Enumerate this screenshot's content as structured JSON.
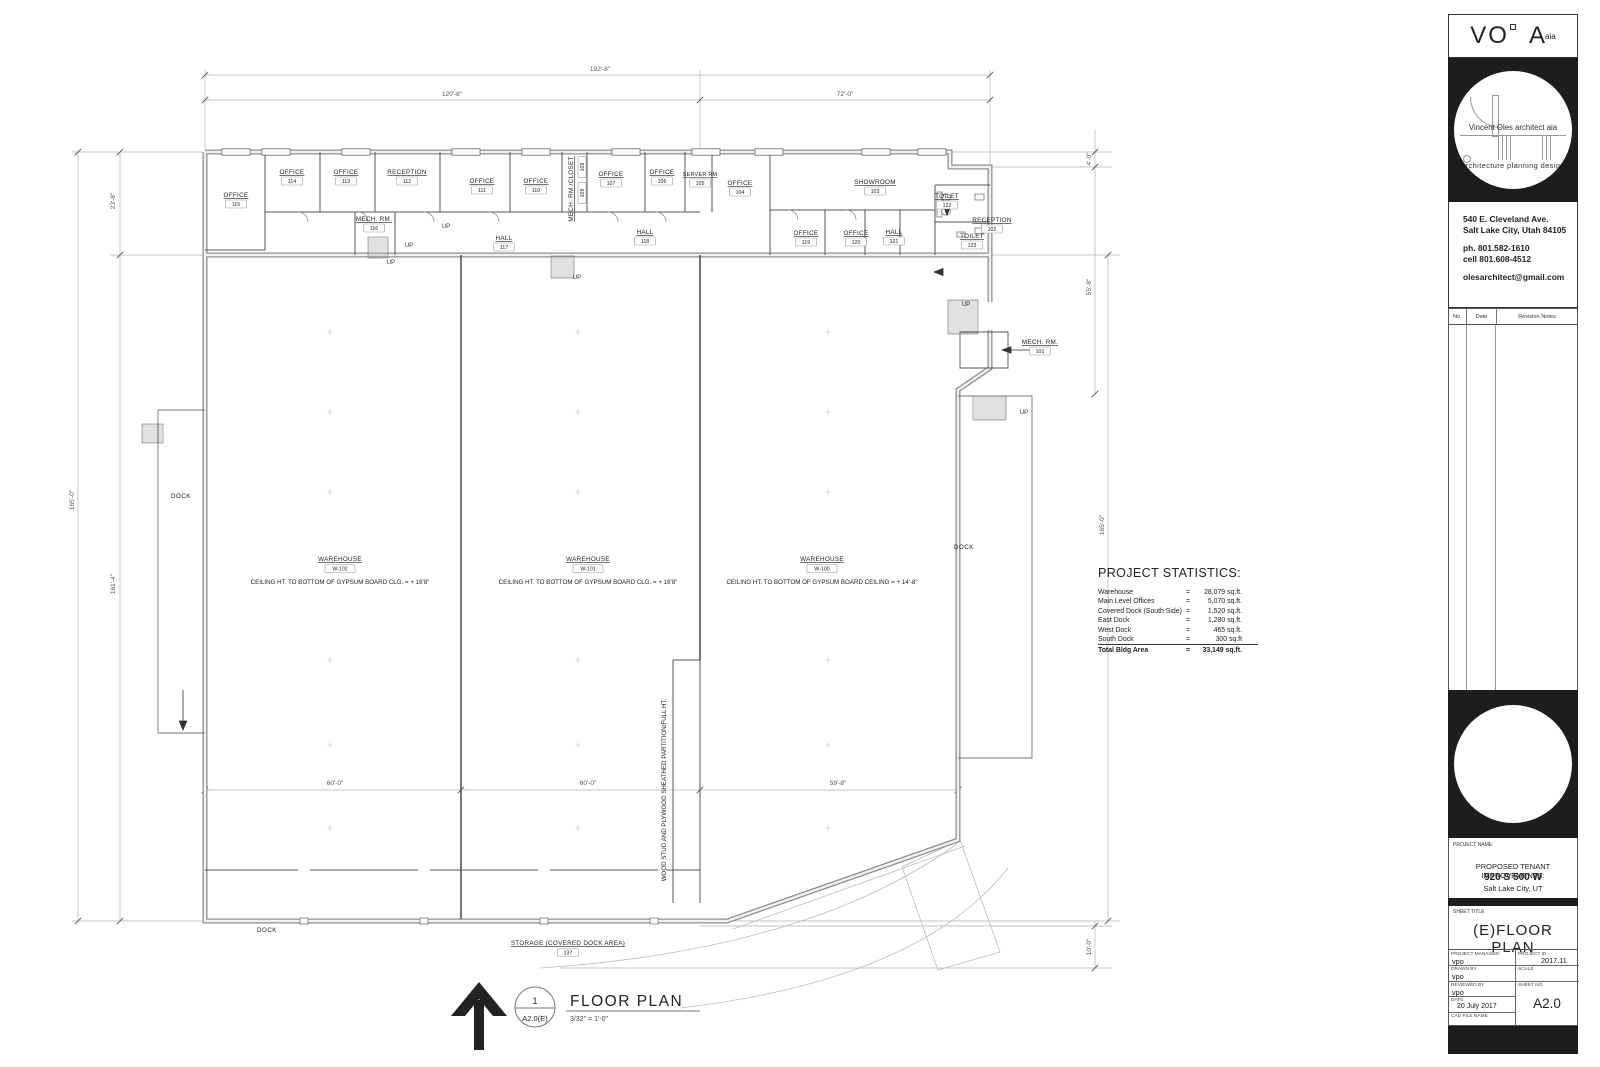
{
  "title_block": {
    "logo": {
      "vo": "VO",
      "a": "A",
      "aia": "aia"
    },
    "circle_text1": "Vincent Oles architect aia",
    "circle_text2": "architecture  planning  design",
    "address1": "540 E. Cleveland Ave.",
    "address2": "Salt Lake City, Utah 84105",
    "phone": "ph. 801.582-1610",
    "cell": "cell 801.608-4512",
    "email": "olesarchitect@gmail.com",
    "rev_headers": {
      "no": "No.",
      "date": "Date",
      "notes": "Revision Notes"
    },
    "project_name_label": "PROJECT NAME:",
    "project_line1": "PROPOSED TENANT IMPROVEMENTS:",
    "project_line2": "920 S 500 W",
    "project_line3": "Salt Lake City, UT",
    "sheet_title_label": "SHEET TITLE",
    "sheet_title": "(E)FLOOR  PLAN",
    "pm_label": "PROJECT MANAGER:",
    "pm": "vpo",
    "pid_label": "PROJECT ID",
    "pid": "2017.11",
    "drawn_label": "DRAWN BY",
    "drawn": "vpo",
    "scale_label": "SCALE",
    "reviewed_label": "REVIEWED BY",
    "reviewed": "vpo",
    "sheetno_label": "SHEET NO.",
    "sheetno": "A2.0",
    "date_label": "DATE",
    "date": "20 July 2017",
    "cad_label": "CAD FILE NAME"
  },
  "plan": {
    "title": {
      "num": "1",
      "ref": "A2.0(E)",
      "name": "FLOOR PLAN",
      "scale": "3/32\" = 1'-0\""
    },
    "stats": {
      "title": "PROJECT STATISTICS:",
      "eq": "=",
      "rows": [
        {
          "n": "Warehouse",
          "v": "28,079 sq.ft."
        },
        {
          "n": "Main Level Offices",
          "v": "5,070 sq.ft."
        },
        {
          "n": "Covered Dock (South Side)",
          "v": "1,520 sq.ft."
        },
        {
          "n": "East Dock",
          "v": "1,280 sq.ft."
        },
        {
          "n": "West Dock",
          "v": "465 sq.ft."
        },
        {
          "n": "South Dock",
          "v": "300 sq.ft",
          "underline": true
        }
      ],
      "total": {
        "n": "Total Bldg Area",
        "v": "33,149 sq.ft."
      }
    },
    "rooms": [
      {
        "n": "OFFICE",
        "id": "115",
        "x": 236,
        "y": 197
      },
      {
        "n": "OFFICE",
        "id": "114",
        "x": 292,
        "y": 174
      },
      {
        "n": "OFFICE",
        "id": "113",
        "x": 346,
        "y": 174
      },
      {
        "n": "RECEPTION",
        "id": "112",
        "x": 407,
        "y": 174
      },
      {
        "n": "MECH. RM.",
        "id": "116",
        "x": 374,
        "y": 221
      },
      {
        "n": "OFFICE",
        "id": "111",
        "x": 482,
        "y": 183
      },
      {
        "n": "OFFICE",
        "id": "110",
        "x": 536,
        "y": 183
      },
      {
        "n": "OFFICE",
        "id": "107",
        "x": 611,
        "y": 176
      },
      {
        "n": "OFFICE",
        "id": "106",
        "x": 662,
        "y": 174
      },
      {
        "n": "SERVER RM",
        "id": "105",
        "x": 700,
        "y": 176,
        "fs": 5.4
      },
      {
        "n": "HALL",
        "id": "117",
        "x": 504,
        "y": 240
      },
      {
        "n": "HALL",
        "id": "118",
        "x": 645,
        "y": 234
      },
      {
        "n": "OFFICE",
        "id": "104",
        "x": 740,
        "y": 185
      },
      {
        "n": "SHOWROOM",
        "id": "103",
        "x": 875,
        "y": 184
      },
      {
        "n": "TOILET",
        "id": "122",
        "x": 947,
        "y": 198
      },
      {
        "n": "OFFICE",
        "id": "119",
        "x": 806,
        "y": 235
      },
      {
        "n": "OFFICE",
        "id": "120",
        "x": 856,
        "y": 235
      },
      {
        "n": "HALL",
        "id": "121",
        "x": 894,
        "y": 234
      },
      {
        "n": "TOILET",
        "id": "123",
        "x": 972,
        "y": 238
      },
      {
        "n": "RECEPTION",
        "id": "102",
        "x": 992,
        "y": 222
      },
      {
        "n": "MECH. RM.",
        "id": "101",
        "x": 1040,
        "y": 344
      }
    ],
    "mech_closet": {
      "name": "MECH. RM./CLOSET",
      "num_top": "108",
      "num_bot": "109"
    },
    "warehouses": [
      {
        "id": "W-102",
        "x": 340,
        "note": "CEILING HT. TO BOTTOM OF GYPSUM BOARD CLG. = + 16'8\""
      },
      {
        "id": "W-101",
        "x": 588,
        "note": "CEILING HT. TO BOTTOM OF GYPSUM BOARD CLG. = + 16'8\""
      },
      {
        "id": "W-100",
        "x": 822,
        "note": "CEILING HT. TO BOTTOM OF GYPSUM BOARD CEILING = + 14'-8\""
      }
    ],
    "dims": [
      {
        "t": "192'-8\"",
        "x": 600,
        "y": 71,
        "r": 0
      },
      {
        "t": "120'-8\"",
        "x": 452,
        "y": 96,
        "r": 0
      },
      {
        "t": "72'-0\"",
        "x": 845,
        "y": 96,
        "r": 0
      },
      {
        "t": "23'-8\"",
        "x": 115,
        "y": 201,
        "r": -90
      },
      {
        "t": "165'-0\"",
        "x": 74,
        "y": 500,
        "r": -90
      },
      {
        "t": "161'-4\"",
        "x": 115,
        "y": 584,
        "r": -90
      },
      {
        "t": "4'-0\"",
        "x": 1091,
        "y": 159,
        "r": -90
      },
      {
        "t": "55'-8\"",
        "x": 1091,
        "y": 287,
        "r": -90
      },
      {
        "t": "165'-0\"",
        "x": 1104,
        "y": 525,
        "r": -90
      },
      {
        "t": "10'-0\"",
        "x": 1091,
        "y": 947,
        "r": -90
      },
      {
        "t": "60'-0\"",
        "x": 335,
        "y": 785,
        "r": 0
      },
      {
        "t": "60'-0\"",
        "x": 588,
        "y": 785,
        "r": 0
      },
      {
        "t": "59'-8\"",
        "x": 838,
        "y": 785,
        "r": 0
      }
    ],
    "up": "UP",
    "ups": [
      {
        "x": 391,
        "y": 264
      },
      {
        "x": 409,
        "y": 247
      },
      {
        "x": 446,
        "y": 228
      },
      {
        "x": 577,
        "y": 279
      },
      {
        "x": 966,
        "y": 306
      },
      {
        "x": 1024,
        "y": 414
      }
    ],
    "docks": [
      {
        "t": "DOCK",
        "x": 181,
        "y": 498
      },
      {
        "t": "DOCK",
        "x": 964,
        "y": 549
      },
      {
        "t": "DOCK",
        "x": 267,
        "y": 932
      }
    ],
    "storage": {
      "name": "STORAGE (COVERED DOCK AREA)",
      "num": "137"
    },
    "partition_note": "WOOD STUD AND PLYWOOD SHEATHED PARTITION/FULL HT."
  }
}
